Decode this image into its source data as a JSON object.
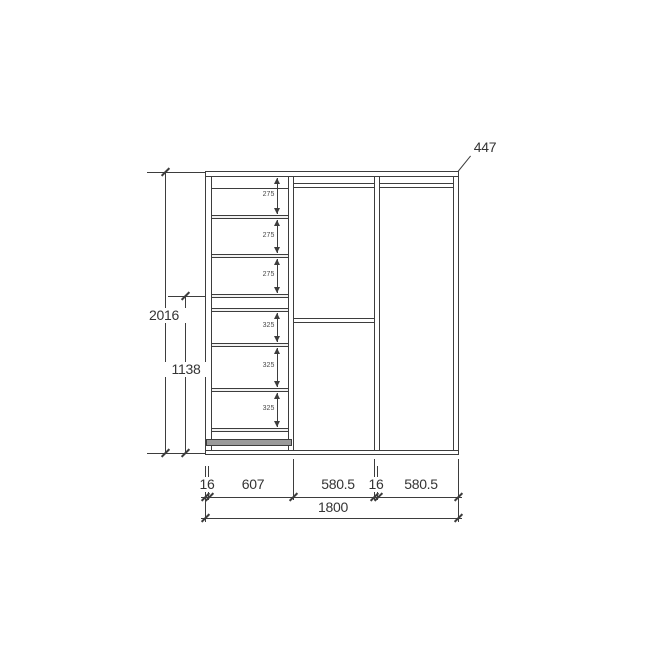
{
  "drawing": {
    "callout_top_right": "447",
    "height_total": "2016",
    "height_partial": "1138",
    "gap_labels": [
      "275",
      "275",
      "275",
      "325",
      "325",
      "325"
    ],
    "bottom_segments": [
      "16",
      "607",
      "580.5",
      "16",
      "580.5"
    ],
    "bottom_total": "1800",
    "colors": {
      "line": "#3d3d3d",
      "background": "#ffffff",
      "text": "#343434",
      "base_band_fill": "#9a9a9a"
    }
  }
}
